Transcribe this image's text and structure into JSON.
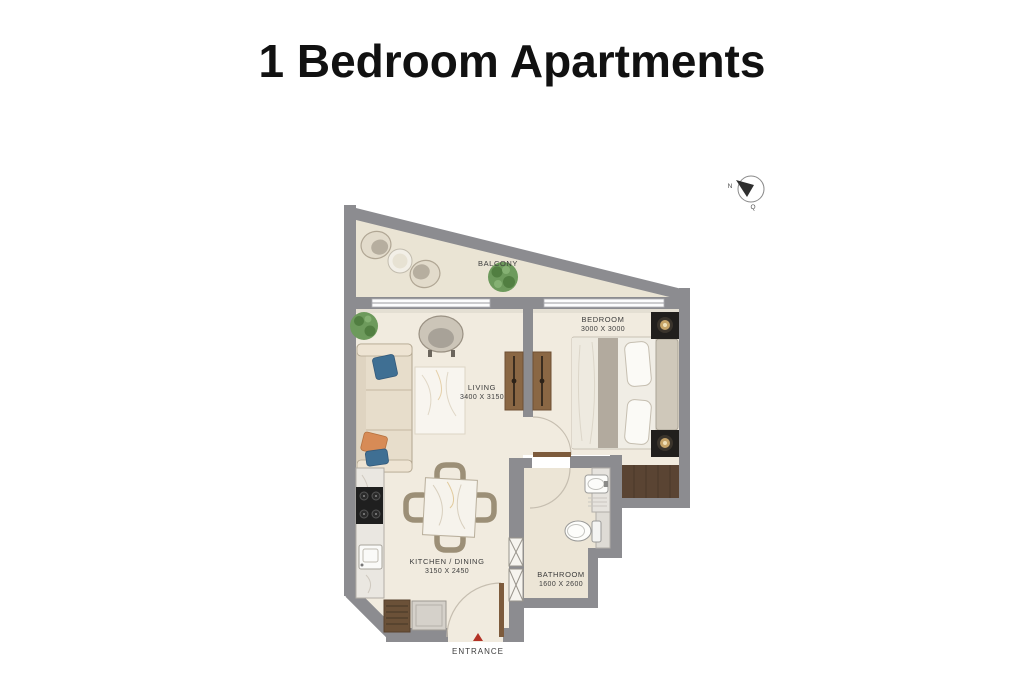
{
  "title": "1 Bedroom Apartments",
  "plan": {
    "rooms": {
      "balcony": {
        "label": "BALCONY"
      },
      "bedroom": {
        "label": "BEDROOM",
        "dimensions": "3000 X 3000"
      },
      "living": {
        "label": "LIVING",
        "dimensions": "3400 X 3150"
      },
      "kitchen_dining": {
        "label": "KITCHEN / DINING",
        "dimensions": "3150 X 2450"
      },
      "bathroom": {
        "label": "BATHROOM",
        "dimensions": "1600 X 2600"
      },
      "entrance": {
        "label": "ENTRANCE"
      }
    },
    "compass": {
      "north": "N",
      "mark": "Q"
    },
    "colors": {
      "wall": "#8c8c90",
      "floor": "#f1ebdf",
      "balcony_floor": "#eae4d4",
      "bathroom_floor": "#ece5d6",
      "wardrobe_wood": "#8a6744",
      "closet_wood": "#5a4433",
      "entrance_marker": "#b33226",
      "title_text": "#111111",
      "label_text": "#3c3c3c",
      "background": "#ffffff"
    }
  }
}
